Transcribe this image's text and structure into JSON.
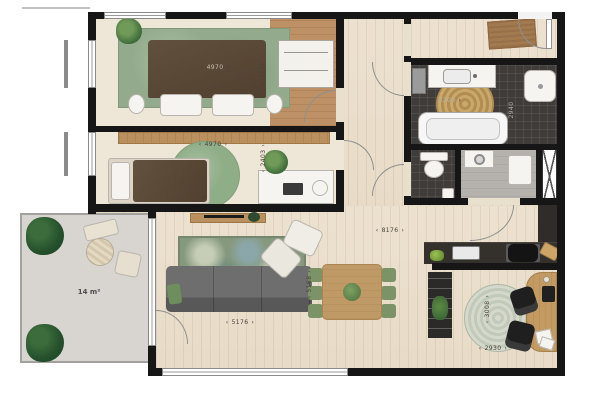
{
  "plan": {
    "terrace": {
      "area": "14 m²"
    },
    "dims": {
      "bedroom1_w": "4970",
      "bedroom1_d": "3120",
      "bedroom2_w": "4970",
      "bedroom2_d": "2403",
      "bath_w": "3200",
      "bath_d": "2940",
      "living_w": "8176",
      "living_d": "5168",
      "living_w2": "5176",
      "study_d": "3008",
      "study_w": "2930"
    },
    "palette": {
      "wall": "#161616",
      "wood_floor": "#e9dfcd",
      "wardrobe_wood": "#bd9065",
      "tile_dark": "#403c39",
      "rug_green": "#93ab8c",
      "dining_green": "#7b9367",
      "terrace_gray": "#d8d5d0"
    }
  }
}
